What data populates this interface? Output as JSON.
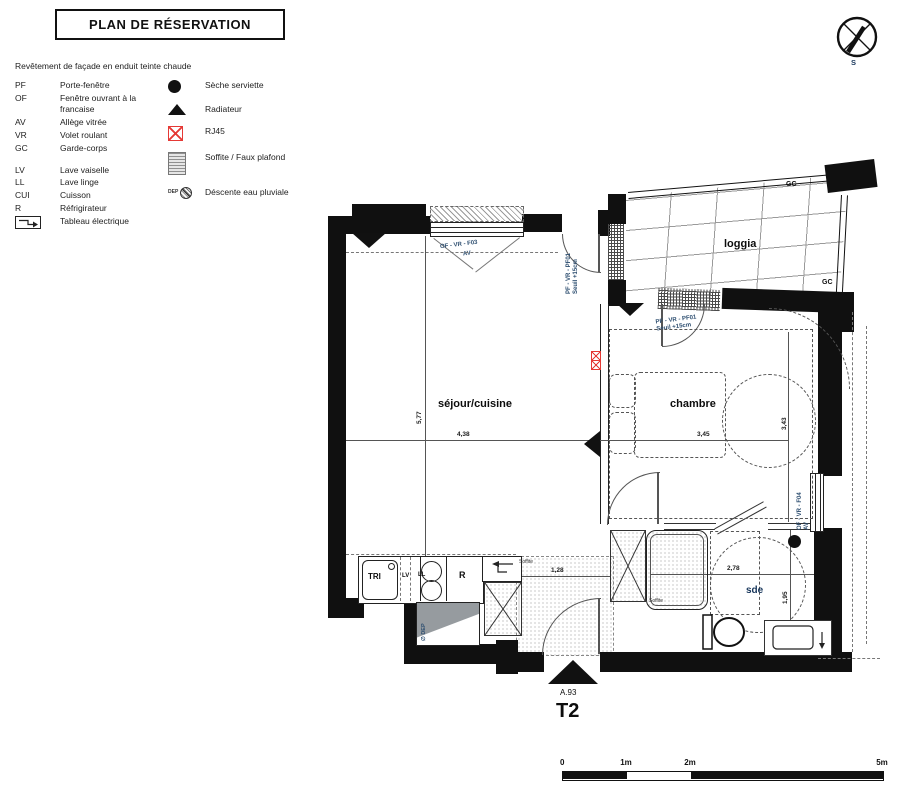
{
  "colors": {
    "wall": "#101010",
    "tech_blue": "#2d4e70",
    "rj45_red": "#e53935"
  },
  "title": "PLAN DE RÉSERVATION",
  "subtitle": "Revêtement de façade en enduit teinte chaude",
  "compass": {
    "south": "S"
  },
  "legend": {
    "col1": [
      {
        "abbr": "PF",
        "label": "Porte-fenêtre"
      },
      {
        "abbr": "OF",
        "label": "Fenêtre ouvrant à la\nfrancaise"
      },
      {
        "abbr": "AV",
        "label": "Allège vitrée"
      },
      {
        "abbr": "VR",
        "label": "Volet roulant"
      },
      {
        "abbr": "GC",
        "label": "Garde-corps"
      },
      {
        "abbr": "LV",
        "label": "Lave vaiselle"
      },
      {
        "abbr": "LL",
        "label": "Lave linge"
      },
      {
        "abbr": "CUI",
        "label": "Cuisson"
      },
      {
        "abbr": "R",
        "label": "Réfrigirateur"
      },
      {
        "abbr": "",
        "label": "Tableau électrique"
      }
    ],
    "col2": [
      {
        "icon": "seche-serviette",
        "label": "Sèche serviette"
      },
      {
        "icon": "radiateur",
        "label": "Radiateur"
      },
      {
        "icon": "rj45",
        "label": "RJ45"
      },
      {
        "icon": "soffite",
        "label": "Soffite /\nFaux plafond"
      },
      {
        "icon": "descente-eau",
        "dep": "DEP",
        "label": "Déscente eau\npluviale"
      }
    ]
  },
  "plan": {
    "rooms": {
      "sejour": "séjour/cuisine",
      "chambre": "chambre",
      "loggia": "loggia",
      "sde": "sde"
    },
    "labels": {
      "gc_top": "GC",
      "gc_right": "GC",
      "window_top": "OF - VR - F03",
      "window_top_av": "AV",
      "door_sejour": "PF - VR - PF01\nSeuil +15cm",
      "door_chambre": "PF - VR - PF01\nSeuil +15cm",
      "window_right": "OF - VR - F04\nAV",
      "soffite_hall": "Soffite",
      "soffite_sde": "Soffite",
      "dep": "∅ DEP"
    },
    "dims": {
      "sejour_h": "5,77",
      "sejour_w": "4,38",
      "chambre_w": "3,45",
      "chambre_h": "3,43",
      "sde_w": "2,78",
      "sde_h": "1,95",
      "hall_w": "1,28"
    },
    "kitchen": {
      "tri": "TRI",
      "lv": "LV",
      "ll": "LL",
      "fridge": "R"
    },
    "unit": {
      "lot": "A.93",
      "type": "T2"
    }
  },
  "scalebar": {
    "labels": [
      "0",
      "1m",
      "2m",
      "5m"
    ]
  }
}
